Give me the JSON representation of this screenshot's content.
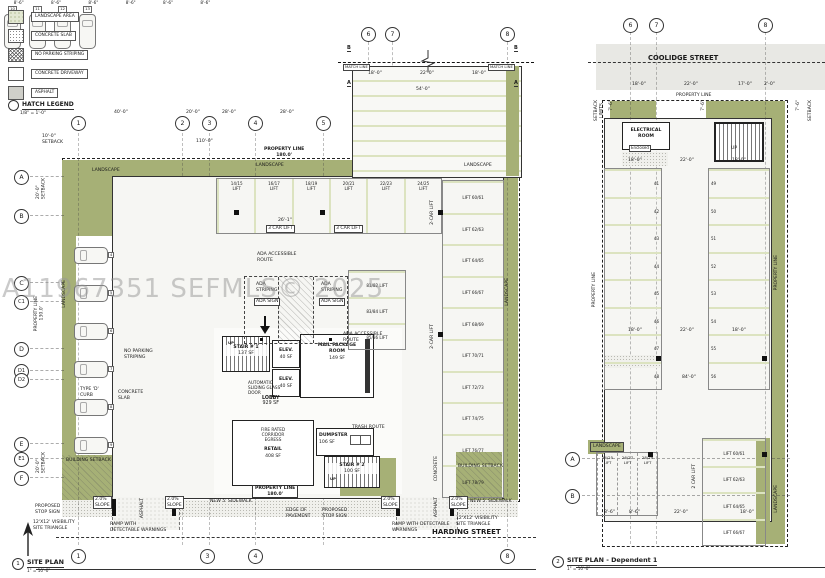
{
  "watermark": "A11967351 SEFMLS© 2025",
  "legend": {
    "title": "HATCH LEGEND",
    "scale": "1/8\" = 1'-0\"",
    "items": [
      {
        "label": "LANDSCAPE AREA"
      },
      {
        "label": "CONCRETE SLAB"
      },
      {
        "label": "NO PARKING STRIPING"
      },
      {
        "label": "CONCRETE DRIVEWAY"
      },
      {
        "label": "ASPHALT"
      }
    ]
  },
  "plan1": {
    "street": "HARDING STREET",
    "title": {
      "num": "1",
      "name": "SITE PLAN",
      "scale": "1\" = 10'-0\""
    },
    "grid_top": [
      "1",
      "2",
      "3",
      "4",
      "5"
    ],
    "grid_upper": [
      "6",
      "7",
      "8"
    ],
    "grid_left": [
      "A",
      "B",
      "C",
      "C1",
      "D",
      "D1",
      "D2",
      "E",
      "E1",
      "F"
    ],
    "grid_bottom": [
      "1",
      "3",
      "4",
      "8"
    ],
    "sections": [
      "B",
      "A",
      "B",
      "A"
    ],
    "top_stalls": [
      "14/15\nLIFT",
      "16/17\nLIFT",
      "18/19\nLIFT",
      "20/21\nLIFT",
      "22/23\nLIFT",
      "24/25\nLIFT"
    ],
    "right_stalls": [
      "LIFT 60/61",
      "LIFT 62/63",
      "LIFT 64/65",
      "LIFT 66/67",
      "LIFT 68/69",
      "LIFT 70/71",
      "LIFT 72/73",
      "LIFT 74/75",
      "LIFT 76/77",
      "LIFT 78/79"
    ],
    "mid_stalls": [
      "81/82 LIFT",
      "83/84 LIFT",
      "85/86 LIFT"
    ],
    "top_cars": [
      "10",
      "11",
      "12",
      "13"
    ],
    "left_cars": [
      "4",
      "5",
      "6",
      "7",
      "8",
      "9"
    ],
    "stall_dims": [
      "8'-6\"",
      "8'-6\"",
      "8'-6\"",
      "8'-6\"",
      "8'-6\"",
      "8'-6\""
    ],
    "rooms": {
      "stair1": {
        "name": "STAIR # 1",
        "area": "137 SF"
      },
      "elev1": {
        "name": "ELEV.",
        "area": "40 SF"
      },
      "elev2": {
        "name": "ELEV.",
        "area": "40 SF"
      },
      "mail": {
        "name": "MAIL PACKAGE\nROOM",
        "area": "149 SF"
      },
      "lobby": {
        "name": "LOBBY",
        "area": "929 SF"
      },
      "retail": {
        "name": "RETAIL",
        "area": "408 SF",
        "corridor_note": "FIRE RATED\nCORRIDOR\nEGRESS"
      },
      "dumpster": {
        "name": "DUMPSTER",
        "area": "106 SF"
      },
      "stair2": {
        "name": "STAIR # 2",
        "area": "100 SF"
      },
      "up_label": "UP"
    },
    "notes": [
      "NO PARKING\nSTRIPING",
      "TYPE 'D'\nCURB",
      "CONCRETE\nSLAB",
      "ADA ACCESSIBLE\nROUTE",
      "ADA\nSTRIPING",
      "ADA SIGN",
      "ADA\nSTRIPING",
      "ADA SIGN",
      "ADA ACCESSIBLE\nROUTE",
      "AUTOMATIC\nSLIDING GLASS\nDOOR",
      "TRASH ROUTE",
      "2.0%\nSLOPE",
      "2.0%\nSLOPE",
      "2.0%\nSLOPE",
      "2.0%\nSLOPE",
      "RAMP WITH\nDETECTABLE WARNINGS",
      "RAMP WITH DETECTABLE\nWARNINGS",
      "PROPOSED\nSTOP SIGN",
      "12'X12' VISIBILITY\nSITE TRIANGLE",
      "PROPOSED\nSTOP SIGN",
      "12'X12' VISIBILITY\nSITE TRIANGLE",
      "NEW 5' SIDEWALK",
      "NEW 5' SIDEWALK",
      "BUILDING SETBACK",
      "BUILDING SETBACK",
      "PROPERTY LINE\n180.0'",
      "EDGE OF\nPAVEMENT",
      "PROPERTY LINE\n180.0'",
      "110'-0\"",
      "40'-0\"",
      "20'-0\"",
      "28'-0\"",
      "28'-0\"",
      "10'-0\"\nSETBACK",
      "18'-0\"",
      "22'-0\"",
      "18'-0\"",
      "54'-0\"",
      "26'-1\"",
      "3 CAR LIFT",
      "3 CAR LIFT",
      "MATCH LINE",
      "MATCH LINE",
      "LANDSCAPE",
      "LANDSCAPE",
      "LANDSCAPE"
    ],
    "vnotes": [
      "LANDSCAPE",
      "LANDSCAPE",
      "PROPERTY LINE\n130.0'",
      "20'-0\"\nSETBACK",
      "20'-0\"\nSETBACK",
      "ASPHALT",
      "CONCRETE",
      "ASPHALT",
      "2-CAR LIFT",
      "2-CAR LIFT"
    ]
  },
  "plan2": {
    "street": "COOLIDGE STREET",
    "title": {
      "num": "2",
      "name": "SITE PLAN - Dependent 1",
      "scale": "1\" = 10'-0\""
    },
    "grid_top": [
      "6",
      "7",
      "8"
    ],
    "grid_side": [
      "A",
      "B"
    ],
    "electrical": {
      "name": "ELECTRICAL\nROOM"
    },
    "left_stalls": [
      "41",
      "42",
      "43",
      "44",
      "45",
      "46",
      "47",
      "48"
    ],
    "right_stalls": [
      "49",
      "50",
      "51",
      "52",
      "53",
      "54",
      "55",
      "56"
    ],
    "bottom_left_stalls": [
      "24/25\nLIFT",
      "26/27\nLIFT",
      "28/29\nLIFT"
    ],
    "bottom_right_stalls": [
      "LIFT 60/61",
      "LIFT 62/63",
      "LIFT 64/65",
      "LIFT 66/67"
    ],
    "notes": [
      "PROPERTY LINE",
      "18'-0\"",
      "22'-0\"",
      "17'-0\"",
      "2'-0\"",
      "18'-0\"",
      "22'-0\"",
      "18'-0\"",
      "18'-0\"",
      "22'-0\"",
      "18'-0\"",
      "84'-0\"",
      "22'-0\"",
      "8'-6\"",
      "8'-6\"",
      "18'-0\"",
      "Enclosed",
      "UP",
      "LANDSCAPE",
      "7'-6\"",
      "7'-6\"",
      "7'-6\"",
      "SETBACK",
      "SETBACK\nLIMITS",
      "PROPERTY LINE",
      "LANDSCAPE",
      "PROPERTY LINE",
      "2 CAR LIFT"
    ]
  }
}
